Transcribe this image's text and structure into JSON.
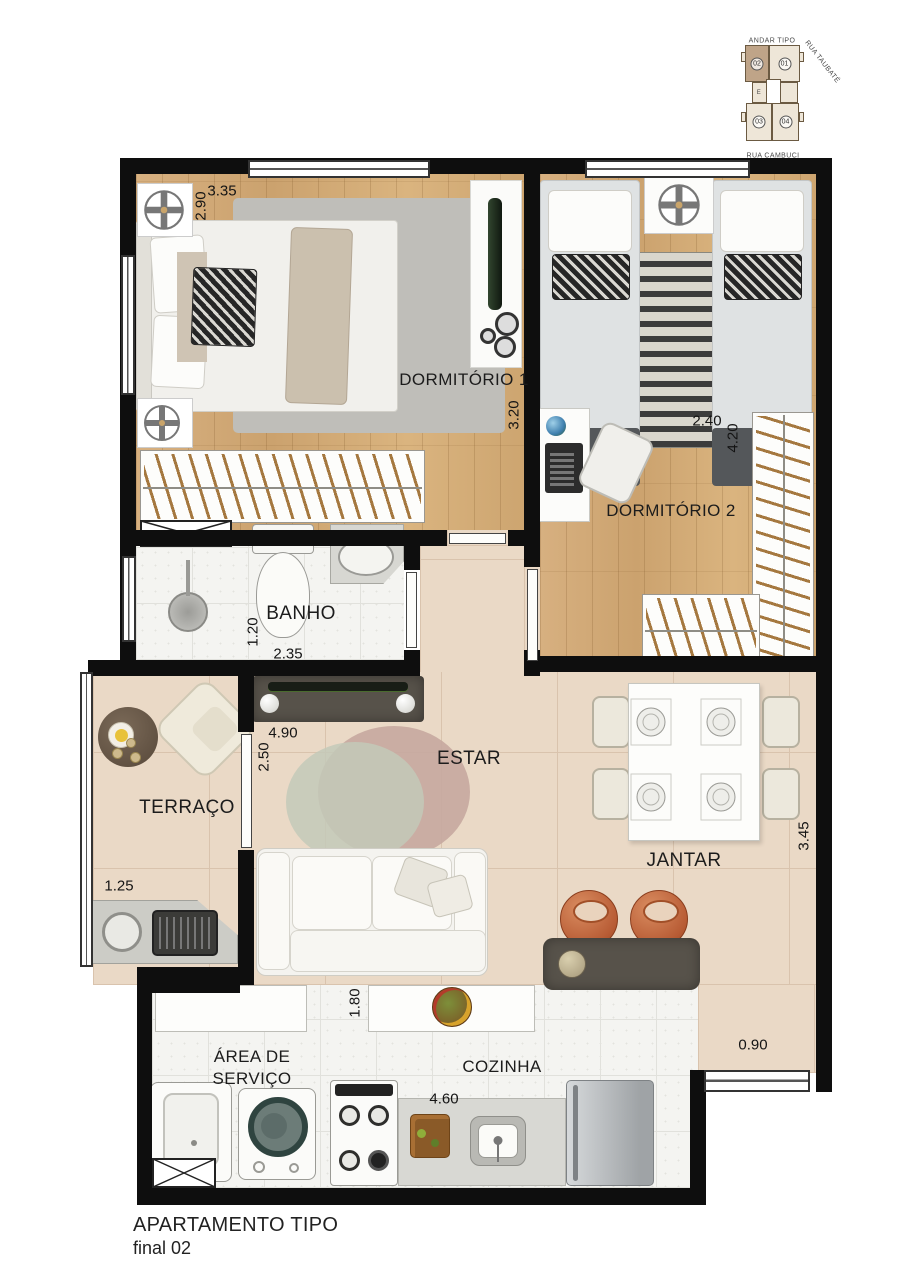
{
  "key_plan": {
    "title": "ANDAR TIPO",
    "street_right": "RUA TAUBATÉ",
    "street_bottom": "RUA CAMBUCI",
    "elevator_label": "E",
    "units": [
      {
        "number": "02",
        "highlighted": true
      },
      {
        "number": "01",
        "highlighted": false
      },
      {
        "number": "03",
        "highlighted": false
      },
      {
        "number": "04",
        "highlighted": false
      }
    ]
  },
  "rooms": {
    "dorm1": "DORMITÓRIO 1",
    "dorm2": "DORMITÓRIO 2",
    "banho": "BANHO",
    "terraco": "TERRAÇO",
    "estar": "ESTAR",
    "jantar": "JANTAR",
    "servico": "ÁREA DE SERVIÇO",
    "cozinha": "COZINHA"
  },
  "dimensions": {
    "dorm1_w": "3.35",
    "dorm1_h": "2.90",
    "dorm1_d": "3.20",
    "dorm2_w": "2.40",
    "dorm2_h": "4.20",
    "banho_h": "1.20",
    "banho_w": "2.35",
    "estar_w": "4.90",
    "estar_h": "2.50",
    "terraco_w": "1.25",
    "jantar_h": "3.45",
    "cozinha_top": "1.80",
    "jantar_pass": "0.90",
    "cozinha_w": "4.60"
  },
  "title_block": {
    "line1": "APARTAMENTO TIPO",
    "line2": "final 02"
  },
  "colors": {
    "wall": "#0e0e0e",
    "wood_floor": "#d2ab77",
    "living_floor": "#ead9c6",
    "wet_floor": "#f4f4f1",
    "terracotta": "#bf6746",
    "dark_furniture": "#57524a",
    "keyplan_highlight": "#bfa488"
  }
}
